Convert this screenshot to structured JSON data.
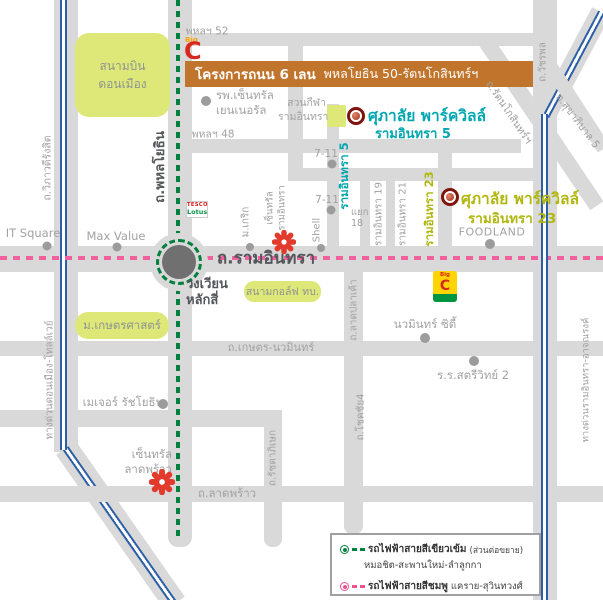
{
  "banner": {
    "project": "โครงการถนน 6 เลน",
    "route": "พหลโยธิน 50-รัตนโกสินทร์ฯ"
  },
  "areas": {
    "donmueang": "สนามบิน\nดอนเมือง",
    "kasetsart": "ม.เกษตรศาสตร์",
    "golf": "สนามกอล์ฟ ทบ."
  },
  "roads": {
    "phahon52": "พหลฯ 52",
    "phahon48": "พหลฯ 48",
    "vibhavadi": "ถ.วิภาวดีรังสิต",
    "tollway": "ทางด่วนดอนเมือง-โทลล์เวย์",
    "phahonyothin": "ถ.พหลโยธิน",
    "ramintra": "ถ.รามอินทรา",
    "wongwian": "วงเวียน\nหลักสี่",
    "kaset_nawamin": "ถ.เกษตร-นวมินทร์",
    "ladprao": "ถ.ลาดพร้าว",
    "ratchadaphisek": "ถ.รัชดาภิเษก",
    "ladplakao": "ถ.ลาดปลาเค้า",
    "chokchai4": "ถ.โชคชัย4",
    "expressway": "ทางด่วนรามอินทรา-อาจณรงค์",
    "watcharaphon": "ถ.วัชรพล",
    "sukhaphiban5": "ถ.สุขาภิบาล 5",
    "rattanakosin": "ถ.รัตนโกสินทร์ฯ",
    "soi5": "รามอินทรา 5",
    "soi19": "รามอินทรา 19",
    "soi21": "รามอินทรา 21",
    "soi23": "รามอินทรา 23",
    "yaek18": "แยก\n18"
  },
  "places": {
    "it_square": "IT Square",
    "max_value": "Max Value",
    "hospital": "รพ.เซ็นทรัล\nเยนเนอรัล",
    "seven11": "7-11",
    "shell": "Shell",
    "foodland": "FOODLAND",
    "krirk": "ม.เกริก",
    "central_ramintra": "เซ็นทรัล\nรามอินทรา",
    "central_ladprao": "เซ็นทรัล\nลาดพร้าว",
    "navamin_city": "นวมินทร์ ซิตี้",
    "satriwit2": "ร.ร.สตรีวิทย์ 2",
    "major_ratchayothin": "เมเจอร์ รัชโยธิน",
    "sport_park": "สวนกีฬา\nรามอินทรา"
  },
  "projects": {
    "p5": {
      "name": "ศุภาลัย พาร์ควิลล์",
      "road": "รามอินทรา 5"
    },
    "p23": {
      "name": "ศุภาลัย พาร์ควิลล์",
      "road": "รามอินทรา 23"
    }
  },
  "logos": {
    "bigc_big": "Big",
    "bigc_c": "C",
    "tesco1": "TESCO",
    "tesco2": "Lotus",
    "extra_big": "Big",
    "extra_c": "C",
    "extra_band": "extra"
  },
  "legend": {
    "green_name": "รถไฟฟ้าสายสีเขียวเข้ม",
    "green_note": "(ส่วนต่อขยาย)",
    "green_route": "หมอชิต-สะพานใหม่-ลำลูกกา",
    "pink_name": "รถไฟฟ้าสายสีชมพู",
    "pink_route": "แคราย-สุวินทวงศ์"
  },
  "colors": {
    "road_gray": "#d9d9d9",
    "area_green": "#dde878",
    "banner_orange": "#c1752c",
    "teal_accent": "#00a6b0",
    "yellow_green_accent": "#b1b70f",
    "green_rail": "#00803e",
    "pink_rail": "#f2609e",
    "blue_tollway": "#2d5fa6",
    "marker_red": "#7e140c",
    "bigc_red": "#d6281e"
  }
}
